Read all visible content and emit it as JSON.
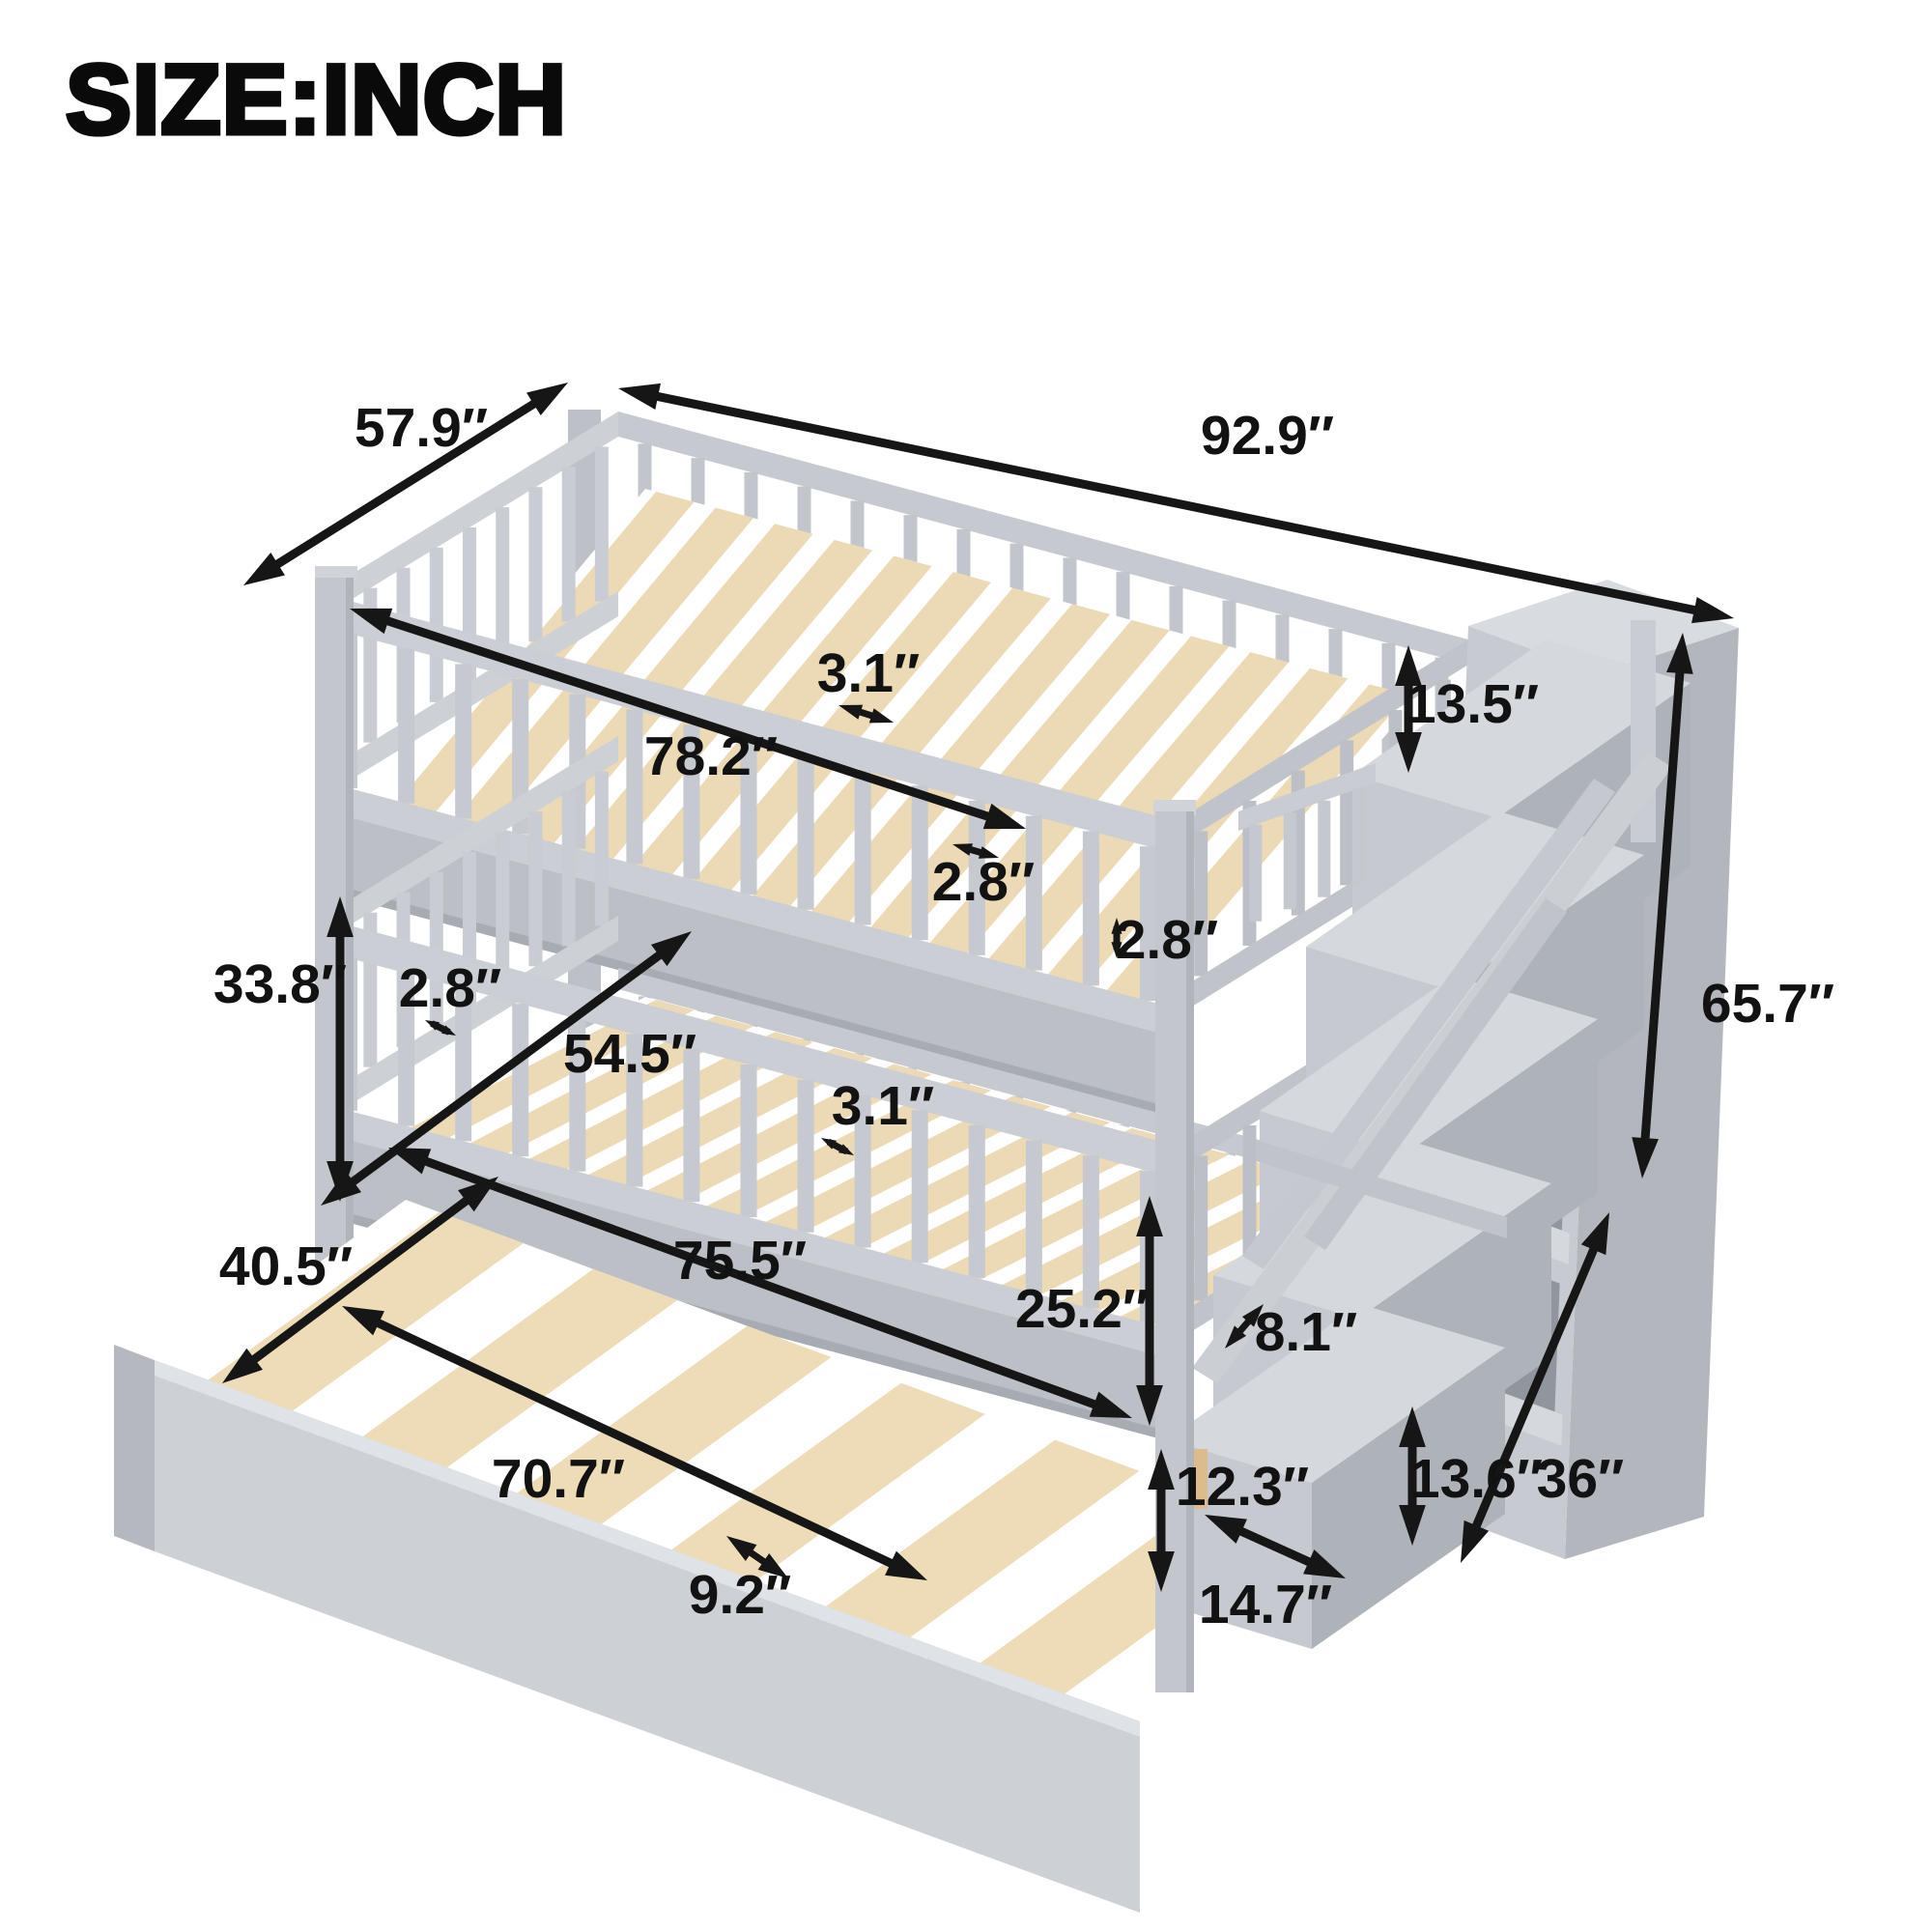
{
  "title": "SIZE:INCH",
  "unit": "inch",
  "dimensions": {
    "upper_depth": "57.9″",
    "overall_length": "92.9″",
    "upper_inner_length": "78.2″",
    "upper_slat_width": "3.1″",
    "guardrail_height": "13.5″",
    "upper_slat_gap": "2.8″",
    "upper_rail_thickness": "2.8″",
    "bunk_clearance": "33.8″",
    "lower_rail_gap": "2.8″",
    "lower_inner_depth": "54.5″",
    "lower_slat_width": "3.1″",
    "overall_height": "65.7″",
    "trundle_width": "40.5″",
    "lower_inner_length": "75.5″",
    "lower_bunk_height": "25.2″",
    "step_depth": "8.1″",
    "trundle_length": "70.7″",
    "trundle_height": "12.3″",
    "step_height": "13.6″",
    "staircase_depth": "36″",
    "trundle_slat_gap": "9.2″",
    "step_width": "14.7″"
  }
}
